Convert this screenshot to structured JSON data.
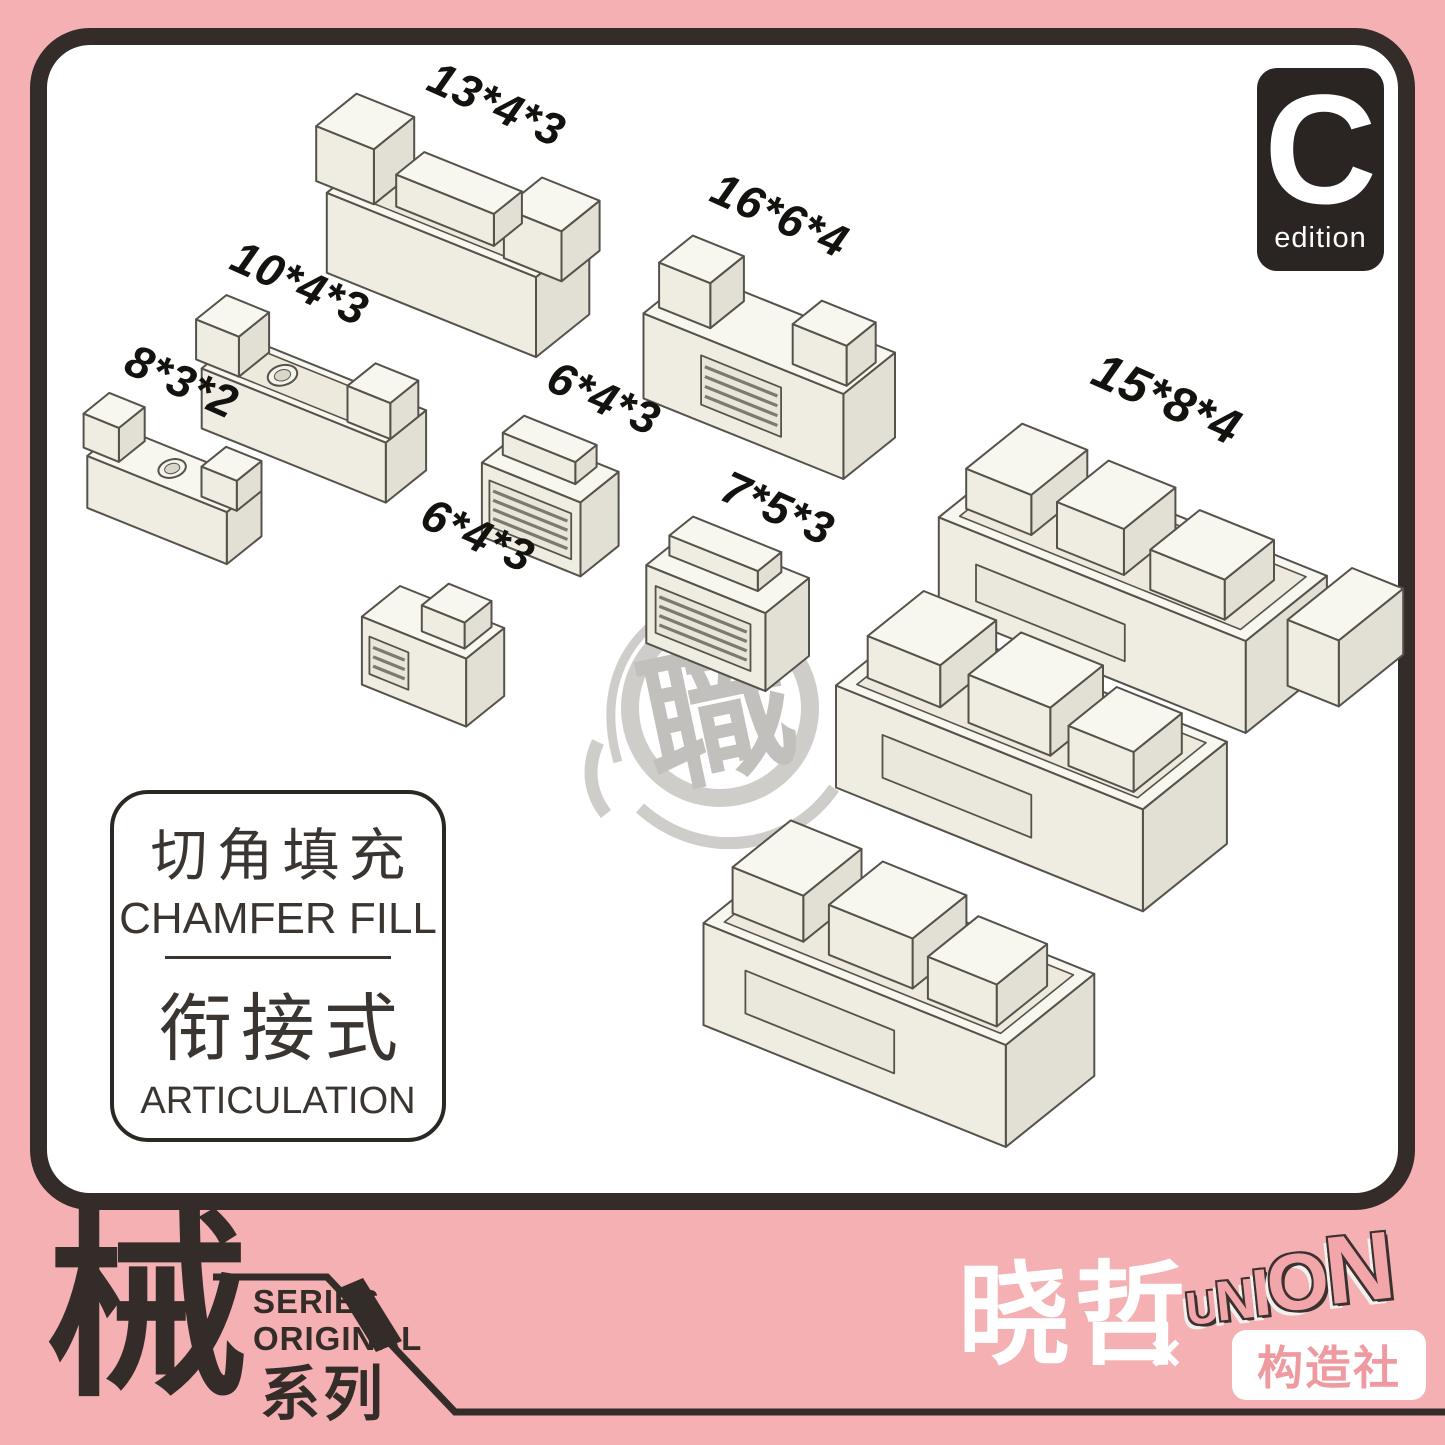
{
  "colors": {
    "background_pink": "#f4b0b2",
    "panel_white": "#ffffff",
    "ink_dark": "#332c29",
    "part_fill": "#f4f3ec",
    "watermark_gray": "#c7c5c1",
    "brand_pink": "#f3a6aa"
  },
  "badge": {
    "letter": "C",
    "label": "edition"
  },
  "watermark": {
    "character": "職"
  },
  "part_labels": [
    {
      "id": "13x4x3",
      "label": "13*4*3"
    },
    {
      "id": "16x6x4",
      "label": "16*6*4"
    },
    {
      "id": "10x4x3",
      "label": "10*4*3"
    },
    {
      "id": "8x3x2",
      "label": "8*3*2"
    },
    {
      "id": "6x4x3-upper",
      "label": "6*4*3"
    },
    {
      "id": "6x4x3-lower",
      "label": "6*4*3"
    },
    {
      "id": "7x5x3",
      "label": "7*5*3"
    },
    {
      "id": "15x8x4",
      "label": "15*8*4"
    }
  ],
  "info_box": {
    "title_zh": "切角填充",
    "title_en": "CHAMFER FILL",
    "subtitle_zh": "衔接式",
    "subtitle_en": "ARTICULATION"
  },
  "footer": {
    "series_character": "械",
    "series_en_line1": "SERIES",
    "series_en_line2": "ORIGINAL",
    "series_zh": "系列",
    "artist_name": "晓哲",
    "collab_mark": "×",
    "brand_name": "UNION",
    "brand_letters": [
      "U",
      "N",
      "I",
      "O",
      "N"
    ],
    "studio_name": "构造社"
  }
}
